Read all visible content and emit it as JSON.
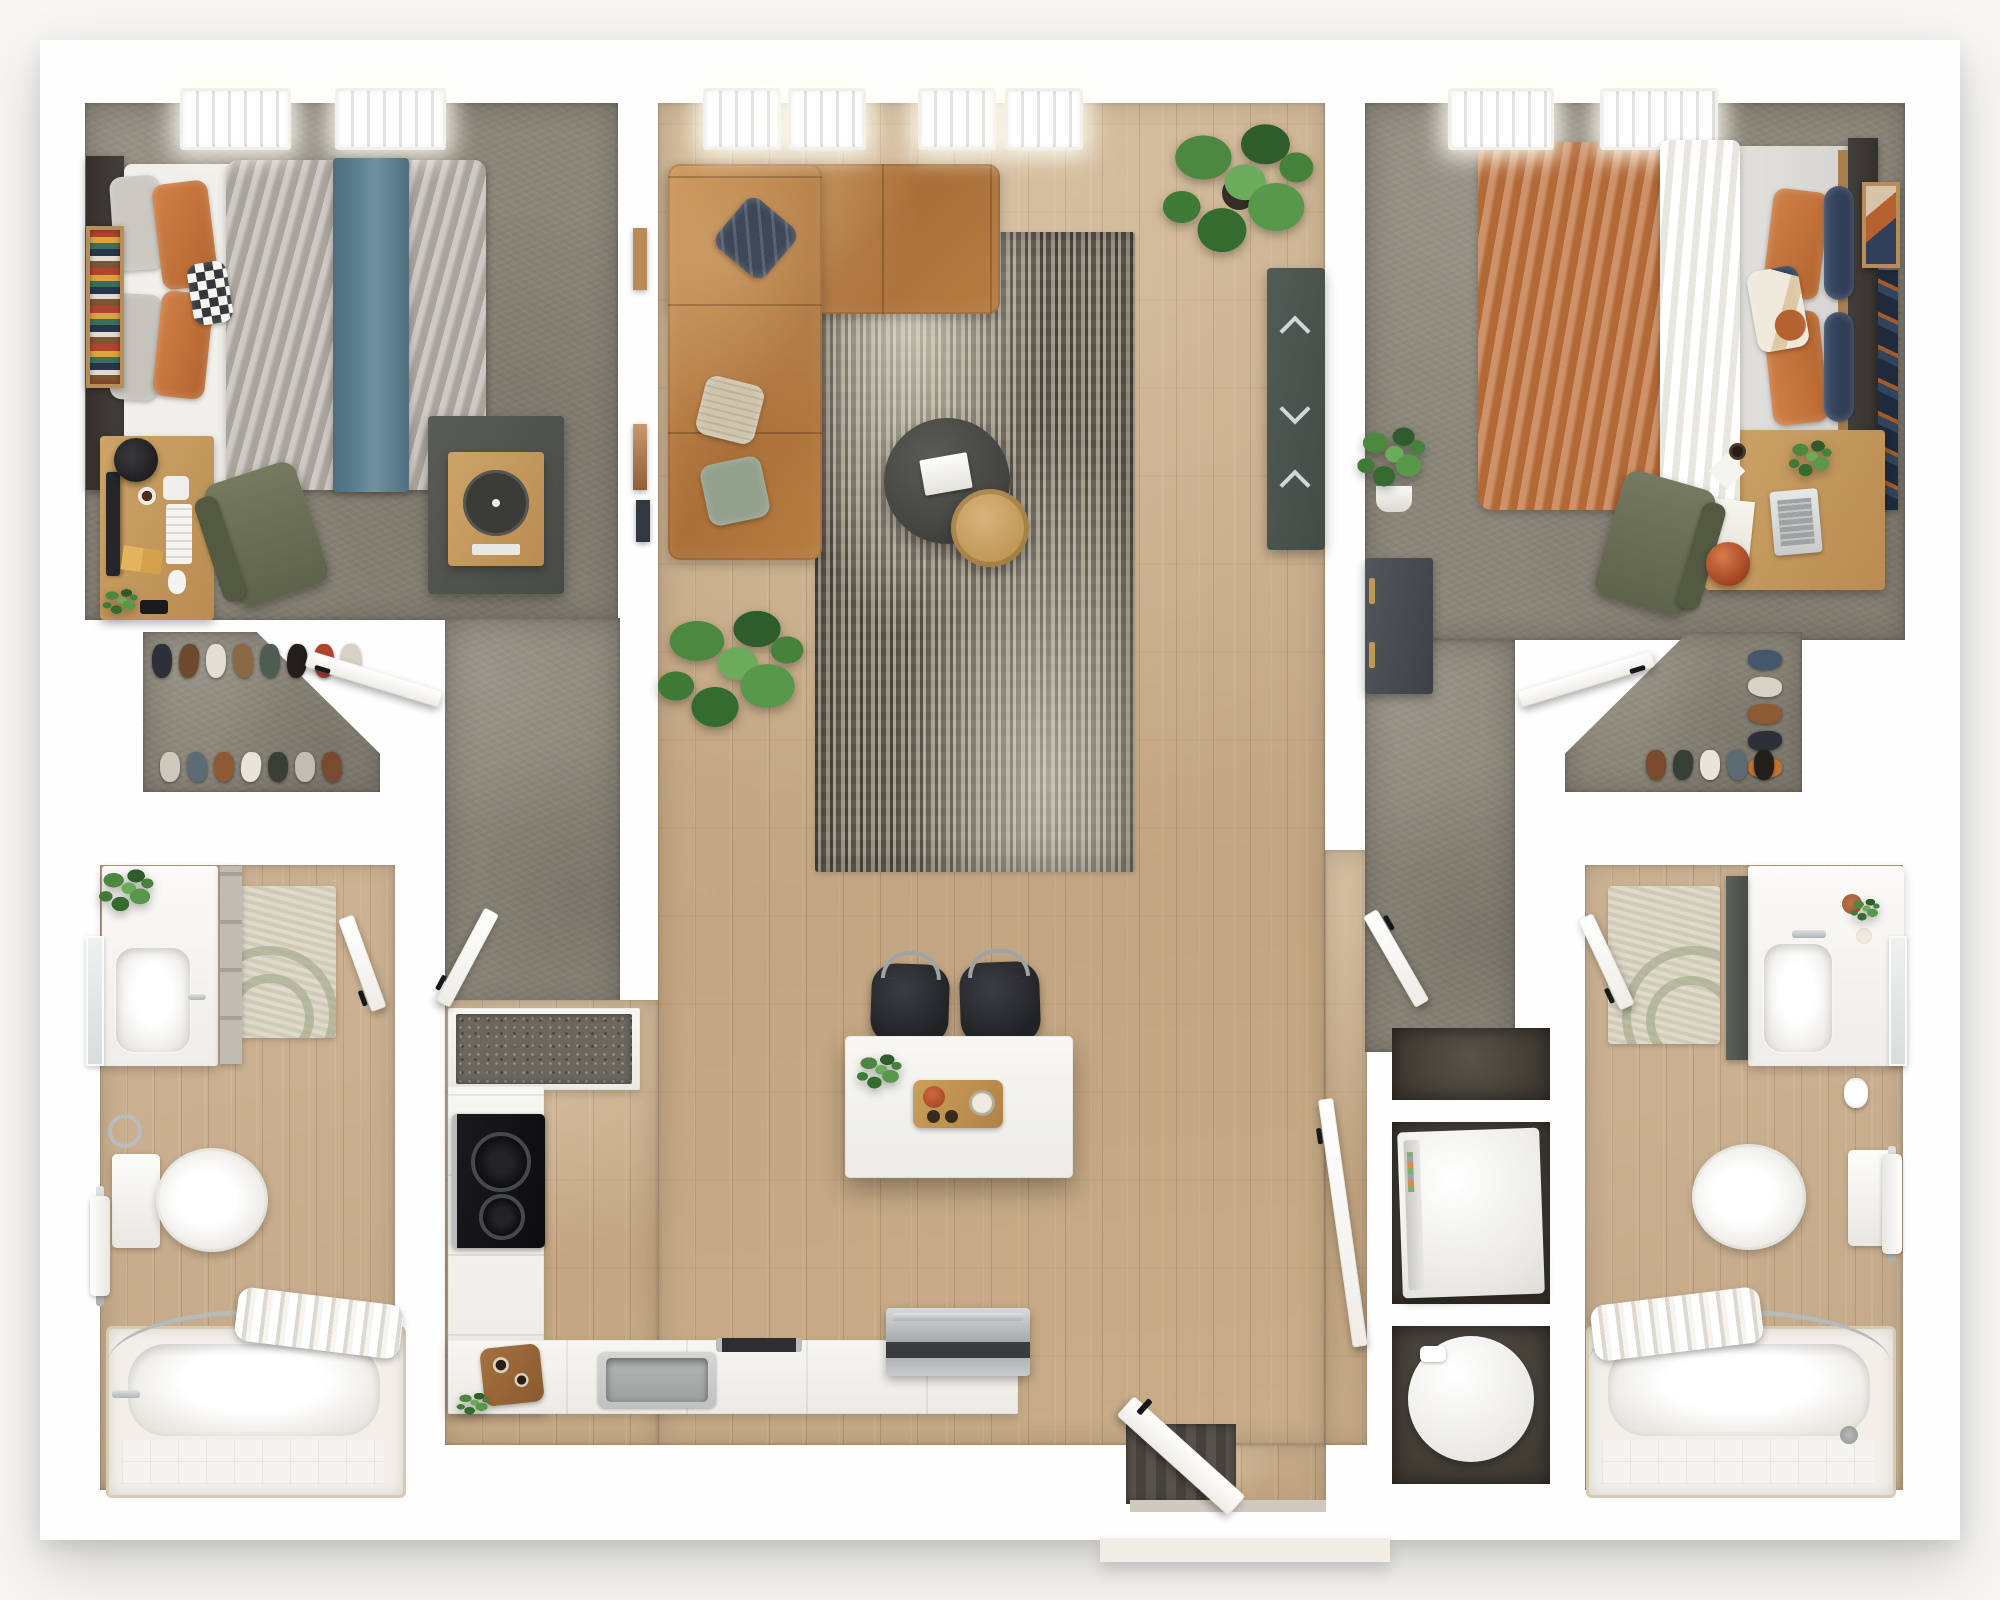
{
  "meta": {
    "title": "3D Top-View Floor Plan — 2 Bedroom / 2 Bathroom Apartment",
    "view": "top-down 3D render",
    "bedrooms_visible": 2,
    "bathrooms_visible": 2
  },
  "palette": {
    "bg": "#f7f6f3",
    "wall": "#fefefe",
    "carpet": "#8b8679",
    "wood": "#c7ac88",
    "woodBath": "#c9ae8e",
    "teal": "#5a7f90",
    "leather": "#b57c42",
    "rugBase": "#6e695c",
    "oak": "#c49a5f",
    "olive": "#6f7359",
    "slate": "#4d554f",
    "charcoal": "#4c4d49",
    "chrome": "#c0c4c4",
    "appliance": "#f2f1ed",
    "nicheDark": "#46413a",
    "terracotta": "#b5542f",
    "brass": "#c09a4e",
    "sheet": "#f1efe9",
    "duvetGray": "#b5b0a8",
    "duvetOrange": "#bf7440",
    "navy": "#31405a",
    "sage": "#93a08b",
    "doormat": "#514d45",
    "granite": "#6c675e"
  },
  "rooms": [
    {
      "id": "bedroom-1",
      "name": "Bedroom 1",
      "floor": "carpet",
      "furniture": [
        "queen bed with gray duvet and teal throw",
        "dark headboard",
        "wall bookshelf",
        "desk with monitor, lamp, keyboard",
        "olive desk chair",
        "media cabinet with turntable",
        "2 ceiling lights"
      ]
    },
    {
      "id": "living-room",
      "name": "Living Room",
      "floor": "hardwood",
      "furniture": [
        "L-shaped tan leather sectional",
        "navy striped pillow",
        "beige pillow",
        "sage pillow",
        "distressed area rug",
        "round charcoal coffee table with magazines",
        "round oak side table",
        "dark media console with chrome pulls",
        "monstera plant",
        "floor plant",
        "wall art frames",
        "4 ceiling lights"
      ]
    },
    {
      "id": "bedroom-2",
      "name": "Bedroom 2",
      "floor": "carpet",
      "furniture": [
        "queen bed with orange duvet and white runner",
        "orange and navy pillows",
        "dark headboard",
        "desk with laptop, papers, plant",
        "olive desk chair",
        "orange vase",
        "dark dresser with brass pulls",
        "potted plant",
        "leaning wall art",
        "2 ceiling lights"
      ]
    },
    {
      "id": "walk-in-closet-1",
      "name": "Walk-in Closet 1",
      "floor": "carpet",
      "furniture": [
        "shoe rows"
      ]
    },
    {
      "id": "walk-in-closet-2",
      "name": "Walk-in Closet 2",
      "floor": "carpet",
      "furniture": [
        "shoe rows"
      ]
    },
    {
      "id": "bathroom-1",
      "name": "Bathroom 1",
      "floor": "wood tile",
      "furniture": [
        "vanity with sink",
        "wall mirror",
        "tall shelf",
        "plant",
        "arc-pattern bath rug",
        "toilet",
        "towel ring and bar",
        "bathtub with shower curtain"
      ]
    },
    {
      "id": "bathroom-2",
      "name": "Bathroom 2",
      "floor": "wood tile",
      "furniture": [
        "vanity with sink",
        "wall mirror",
        "dark storage cabinet",
        "arc-pattern bath rug",
        "toilet",
        "toilet-paper holder",
        "towel bar",
        "bathtub with shower curtain"
      ]
    },
    {
      "id": "kitchen",
      "name": "Kitchen",
      "floor": "hardwood",
      "furniture": [
        "tall cabinet with stone counter",
        "black cooktop",
        "L-shaped counter",
        "cutting board with coffee set",
        "stainless sink",
        "stainless range",
        "white island",
        "2 black bar stools",
        "herb plant",
        "wood serving tray"
      ]
    },
    {
      "id": "laundry",
      "name": "Laundry Closet",
      "floor": "niches",
      "furniture": [
        "shelf niche",
        "washer",
        "dryer"
      ]
    },
    {
      "id": "entry",
      "name": "Entry",
      "floor": "hardwood",
      "furniture": [
        "front door",
        "doormat",
        "threshold step"
      ]
    }
  ]
}
